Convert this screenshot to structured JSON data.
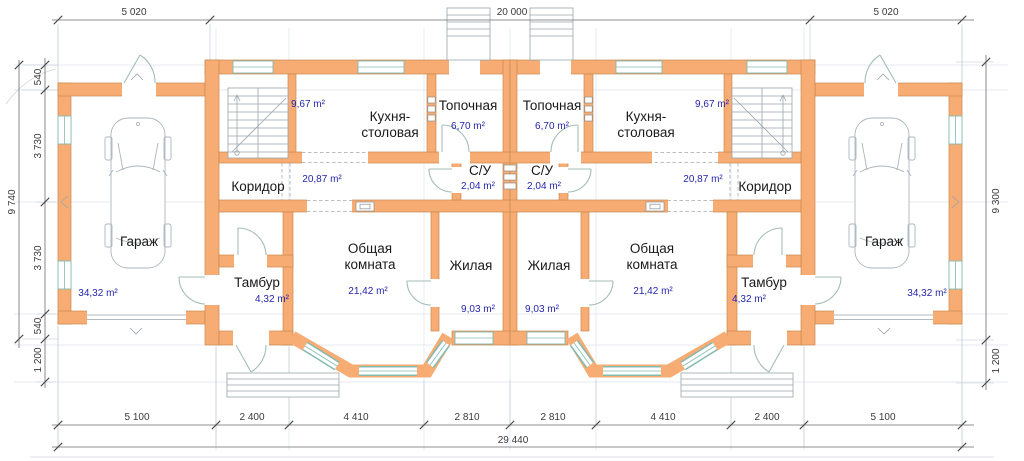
{
  "plan": {
    "rooms": {
      "garage": {
        "name": "Гараж",
        "area": "34,32 m²"
      },
      "corridor": {
        "name": "Коридор",
        "area": "20,87 m²"
      },
      "kitchen": {
        "name1": "Кухня-",
        "name2": "столовая",
        "area": "9,67 m²"
      },
      "boiler": {
        "name": "Топочная",
        "area": "6,70 m²"
      },
      "wc": {
        "name": "С/У",
        "area": "2,04 m²"
      },
      "common": {
        "name1": "Общая",
        "name2": "комната",
        "area": "21,42 m²"
      },
      "living": {
        "name": "Жилая",
        "area": "9,03 m²"
      },
      "vestibule": {
        "name": "Тамбур",
        "area": "4,32 m²"
      }
    },
    "dims": {
      "top": [
        "5 020",
        "20 000",
        "5 020"
      ],
      "bottom": [
        "5 100",
        "2 400",
        "4 410",
        "2 810",
        "2 810",
        "4 410",
        "2 400",
        "5 100"
      ],
      "total": "29 440",
      "left_outer": "9 740",
      "left": [
        "540",
        "3 730",
        "3 730",
        "540"
      ],
      "left_bottom": "1 200",
      "right": [
        "9 300",
        "1 200"
      ]
    },
    "colors": {
      "wall": "#F6AC73",
      "window": "#85BAB1",
      "area_text": "#2525AD"
    }
  }
}
